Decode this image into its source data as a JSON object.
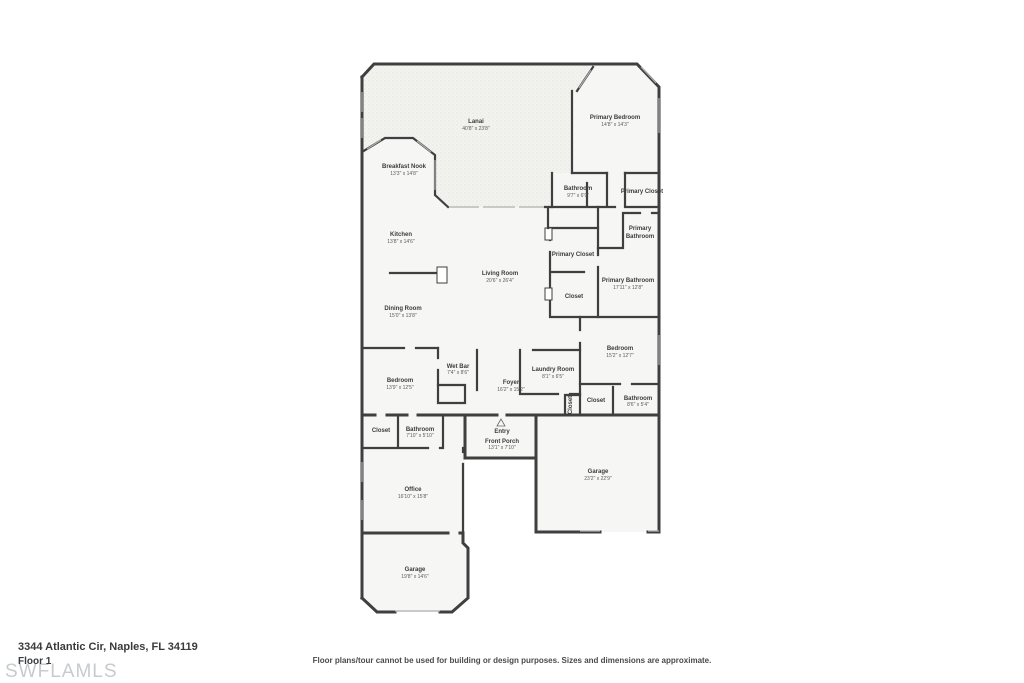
{
  "meta": {
    "address": "3344 Atlantic Cir, Naples, FL 34119",
    "floor_label": "Floor 1",
    "watermark": "SWFLAMLS",
    "disclaimer": "Floor plans/tour cannot be used for building or design purposes. Sizes and dimensions are approximate."
  },
  "colors": {
    "wall": "#3f3f3f",
    "floor_fill": "#f6f6f4",
    "lanai_fill": "#f2f2ef",
    "label_text": "#3c3c3c",
    "watermark_text": "#c7cbce"
  },
  "rooms": [
    {
      "name": "Lanai",
      "dims": "40'8\" x 23'8\""
    },
    {
      "name": "Primary Bedroom",
      "dims": "14'8\" x 14'3\""
    },
    {
      "name": "Breakfast Nook",
      "dims": "13'3\" x 14'8\""
    },
    {
      "name": "Bathroom",
      "dims": "9'7\" x 6'9\""
    },
    {
      "name": "Primary Closet",
      "dims": ""
    },
    {
      "name": "Primary",
      "name2": "Bathroom",
      "dims": ""
    },
    {
      "name": "Kitchen",
      "dims": "13'8\" x 14'6\""
    },
    {
      "name": "Primary Closet",
      "dims": ""
    },
    {
      "name": "Living Room",
      "dims": "20'6\" x 26'4\""
    },
    {
      "name": "Primary Bathroom",
      "dims": "17'11\" x 12'8\""
    },
    {
      "name": "Closet",
      "dims": ""
    },
    {
      "name": "Dining Room",
      "dims": "15'0\" x 13'8\""
    },
    {
      "name": "Bedroom",
      "dims": "15'2\" x 12'7\""
    },
    {
      "name": "Wet Bar",
      "dims": "7'4\" x 8'6\""
    },
    {
      "name": "Laundry Room",
      "dims": "8'1\" x 6'5\""
    },
    {
      "name": "Bedroom",
      "dims": "13'9\" x 12'5\""
    },
    {
      "name": "Foyer",
      "dims": "16'2\" x 15'2\""
    },
    {
      "name": "Closet",
      "dims": ""
    },
    {
      "name": "Closet",
      "dims": ""
    },
    {
      "name": "Bathroom",
      "dims": "8'6\" x 5'4\""
    },
    {
      "name": "Closet",
      "dims": ""
    },
    {
      "name": "Bathroom",
      "dims": "7'10\" x 5'10\""
    },
    {
      "name": "Entry",
      "dims": ""
    },
    {
      "name": "Front Porch",
      "dims": "13'1\" x 7'10\""
    },
    {
      "name": "Garage",
      "dims": "23'2\" x 22'9\""
    },
    {
      "name": "Office",
      "dims": "16'10\" x 15'8\""
    },
    {
      "name": "Garage",
      "dims": "19'8\" x 14'6\""
    }
  ]
}
